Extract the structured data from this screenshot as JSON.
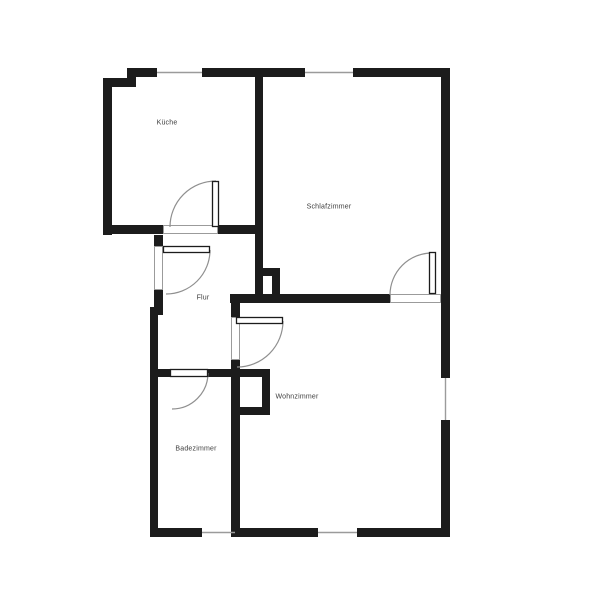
{
  "plan": {
    "title": "apartment-floorplan",
    "canvas": {
      "width": 600,
      "height": 600
    },
    "palette": {
      "wall": "#1c1c1c",
      "window_line": "#9b9b9b",
      "threshold_outline": "#9b9b9b",
      "door_arc": "#8f8f8f",
      "door_leaf_outline": "#1c1c1c",
      "floor": "#ffffff",
      "label_text": "#3d3d3d"
    },
    "rooms": [
      {
        "id": "kueche",
        "name": "Küche",
        "label_x": 167,
        "label_y": 123
      },
      {
        "id": "schlafzimmer",
        "name": "Schlafzimmer",
        "label_x": 329,
        "label_y": 207
      },
      {
        "id": "flur",
        "name": "Flur",
        "label_x": 203,
        "label_y": 298
      },
      {
        "id": "wohnzimmer",
        "name": "Wohnzimmer",
        "label_x": 297,
        "label_y": 397
      },
      {
        "id": "badezimmer",
        "name": "Badezimmer",
        "label_x": 196,
        "label_y": 449
      }
    ],
    "walls": [
      [
        127,
        68,
        30,
        9
      ],
      [
        202,
        68,
        103,
        9
      ],
      [
        353,
        68,
        97,
        9
      ],
      [
        103,
        78,
        33,
        9
      ],
      [
        127,
        68,
        9,
        19
      ],
      [
        103,
        78,
        9,
        157
      ],
      [
        103,
        225,
        60,
        9
      ],
      [
        218,
        225,
        45,
        9
      ],
      [
        255,
        77,
        8,
        226
      ],
      [
        441,
        68,
        9,
        310
      ],
      [
        441,
        420,
        9,
        117
      ],
      [
        150,
        528,
        52,
        9
      ],
      [
        235,
        528,
        83,
        9
      ],
      [
        357,
        528,
        93,
        9
      ],
      [
        150,
        307,
        8,
        230
      ],
      [
        150,
        307,
        13,
        8
      ],
      [
        154,
        235,
        9,
        11
      ],
      [
        154,
        290,
        9,
        17
      ],
      [
        230,
        294,
        160,
        9
      ],
      [
        263,
        268,
        17,
        8
      ],
      [
        272,
        268,
        8,
        35
      ],
      [
        231,
        303,
        9,
        14
      ],
      [
        231,
        360,
        9,
        177
      ],
      [
        150,
        369,
        20,
        8
      ],
      [
        208,
        369,
        23,
        8
      ],
      [
        240,
        369,
        30,
        8
      ],
      [
        262,
        369,
        8,
        46
      ],
      [
        240,
        407,
        30,
        8
      ]
    ],
    "windows": [
      {
        "x1": 157,
        "y1": 72.5,
        "x2": 202,
        "y2": 72.5
      },
      {
        "x1": 305,
        "y1": 72.5,
        "x2": 353,
        "y2": 72.5
      },
      {
        "x1": 445.5,
        "y1": 378,
        "x2": 445.5,
        "y2": 420
      },
      {
        "x1": 202,
        "y1": 532.5,
        "x2": 235,
        "y2": 532.5
      },
      {
        "x1": 318,
        "y1": 532.5,
        "x2": 357,
        "y2": 532.5
      }
    ],
    "door_thresholds": [
      [
        154,
        246,
        9,
        44
      ],
      [
        163,
        225,
        55,
        9
      ],
      [
        390,
        294,
        51,
        9
      ],
      [
        231,
        317,
        9,
        43
      ]
    ],
    "door_leaves": [
      [
        163,
        246,
        47,
        7
      ],
      [
        212,
        181,
        7,
        46
      ],
      [
        170,
        369,
        38,
        8
      ],
      [
        236,
        317,
        47,
        7
      ],
      [
        429,
        252,
        7,
        42
      ]
    ],
    "door_arcs": [
      "M 210 250 A 44 44 0 0 1 166 294",
      "M 216 181 A 46 46 0 0 0 170 227",
      "M 208 373 A 36 36 0 0 1 172 409",
      "M 283 321 A 46 46 0 0 1 237 367",
      "M 432 253 A 42 42 0 0 0 390 295"
    ]
  }
}
